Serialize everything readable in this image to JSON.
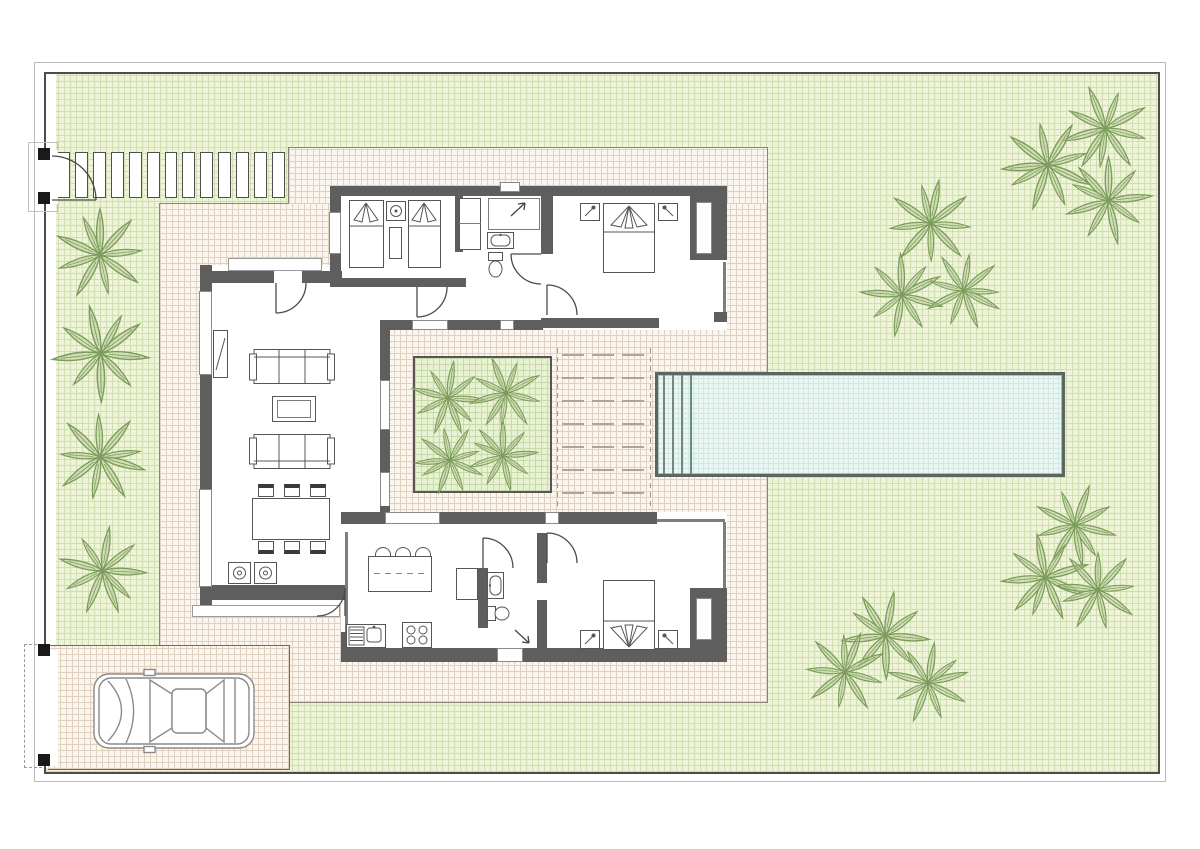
{
  "plan": {
    "type": "villa-floor-plan-site-drawing",
    "visible_text": [],
    "colors": {
      "wall": "#5e5e5e",
      "garden_fill": "#eef3da",
      "garden_grid": "#cfdfae",
      "patio_fill": "#faf6ef",
      "patio_grid": "#e0d1bf",
      "pool_fill": "#ebf6f3",
      "pool_grid": "#d2e8e2",
      "pool_border": "#5b6561",
      "planter_fill": "#e8f1d3",
      "palm_stroke": "#7d9b5d",
      "palm_fill": "#b9cf9b",
      "outline": "#4c4c4c"
    },
    "garden": {
      "walkway_slab_count": 13,
      "trees": [
        {
          "x": 100,
          "y": 255,
          "s": 100
        },
        {
          "x": 100,
          "y": 353,
          "s": 105
        },
        {
          "x": 100,
          "y": 457,
          "s": 100
        },
        {
          "x": 102,
          "y": 570,
          "s": 95
        },
        {
          "x": 1105,
          "y": 128,
          "s": 95
        },
        {
          "x": 1048,
          "y": 165,
          "s": 100
        },
        {
          "x": 1108,
          "y": 200,
          "s": 95
        },
        {
          "x": 930,
          "y": 223,
          "s": 95
        },
        {
          "x": 902,
          "y": 295,
          "s": 90
        },
        {
          "x": 963,
          "y": 290,
          "s": 85
        },
        {
          "x": 1075,
          "y": 525,
          "s": 90
        },
        {
          "x": 1045,
          "y": 577,
          "s": 95
        },
        {
          "x": 1098,
          "y": 590,
          "s": 90
        },
        {
          "x": 885,
          "y": 635,
          "s": 95
        },
        {
          "x": 845,
          "y": 672,
          "s": 90
        },
        {
          "x": 928,
          "y": 683,
          "s": 88
        }
      ]
    },
    "courtyard": {
      "planter_trees": [
        {
          "x": 448,
          "y": 398,
          "s": 80
        },
        {
          "x": 506,
          "y": 393,
          "s": 80
        },
        {
          "x": 450,
          "y": 460,
          "s": 76
        },
        {
          "x": 503,
          "y": 456,
          "s": 76
        }
      ],
      "deck": {
        "rows": 7,
        "dashes_per_row": 3
      }
    },
    "pool": {
      "step_lines": 4
    },
    "summary": {
      "bedrooms": 3,
      "bathrooms": 2,
      "features": [
        "perimeter-fence",
        "pedestrian-gate",
        "vehicle-gate",
        "stepping-stone-walkway",
        "driveway",
        "parked-car",
        "swimming-pool",
        "paved-patio",
        "central-planter-courtyard",
        "sun-deck",
        "living-dining-room",
        "kitchen",
        "laundry-units",
        "palm-trees"
      ]
    }
  }
}
